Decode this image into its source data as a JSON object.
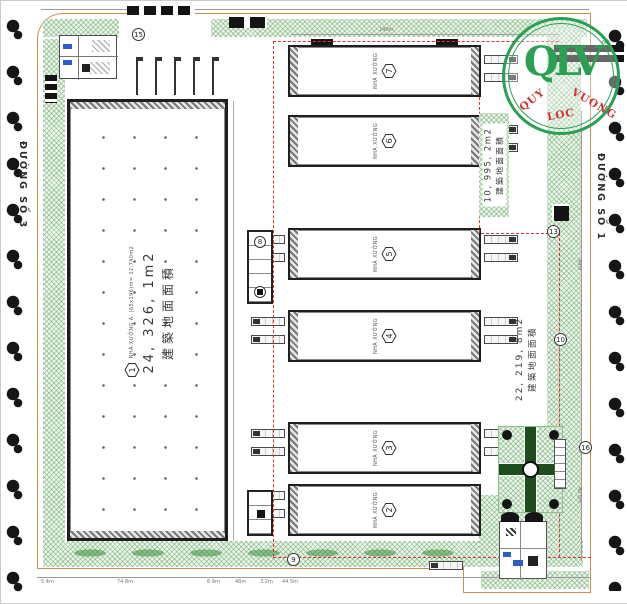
{
  "logo": {
    "name": "QLV",
    "reg": "®",
    "tagline_1": "QUY",
    "tagline_2": "LOC",
    "tagline_3": "VUONG"
  },
  "roads": {
    "left": "ĐƯỜNG SỐ 3",
    "right": "ĐƯỜNG SỐ 1"
  },
  "area_labels": {
    "main": {
      "value": "24, 326, 1m2",
      "cjk": "建築地面面積"
    },
    "upper_right": {
      "value": "10, 995, 2m2",
      "cjk": "建築地面面積"
    },
    "lower_right": {
      "value": "22, 219, 8m2",
      "cjk": "建築地面面積"
    }
  },
  "main_building": {
    "number": "1",
    "name": "NHÀ XƯỞNG A",
    "dims": "(65x196)m= 12,740m2"
  },
  "cluster_buildings": [
    {
      "number": "7",
      "name": "NHÀ XƯỞNG"
    },
    {
      "number": "6",
      "name": "NHÀ XƯỞNG"
    },
    {
      "number": "5",
      "name": "NHÀ XƯỞNG"
    },
    {
      "number": "4",
      "name": "NHÀ XƯỞNG"
    },
    {
      "number": "3",
      "name": "NHÀ XƯỞNG"
    },
    {
      "number": "2",
      "name": "NHÀ XƯỞNG"
    }
  ],
  "callouts": {
    "c15": "15",
    "c9": "9",
    "c13": "13",
    "c10": "10",
    "c16": "16",
    "c8": "8"
  },
  "dimensions": {
    "top": "140m",
    "bottom": [
      "5.4m",
      "74.8m",
      "6.9m",
      "48m",
      "3.2m",
      "44.5m"
    ],
    "right_1": "94m",
    "right_2": "40.5m"
  },
  "colors": {
    "logo_green": "#2aa052",
    "tagline_red": "#cc3333",
    "fire_lane_red": "#e23030",
    "boundary_tan": "#c89050",
    "hatch_green": "#4a8f4a"
  }
}
